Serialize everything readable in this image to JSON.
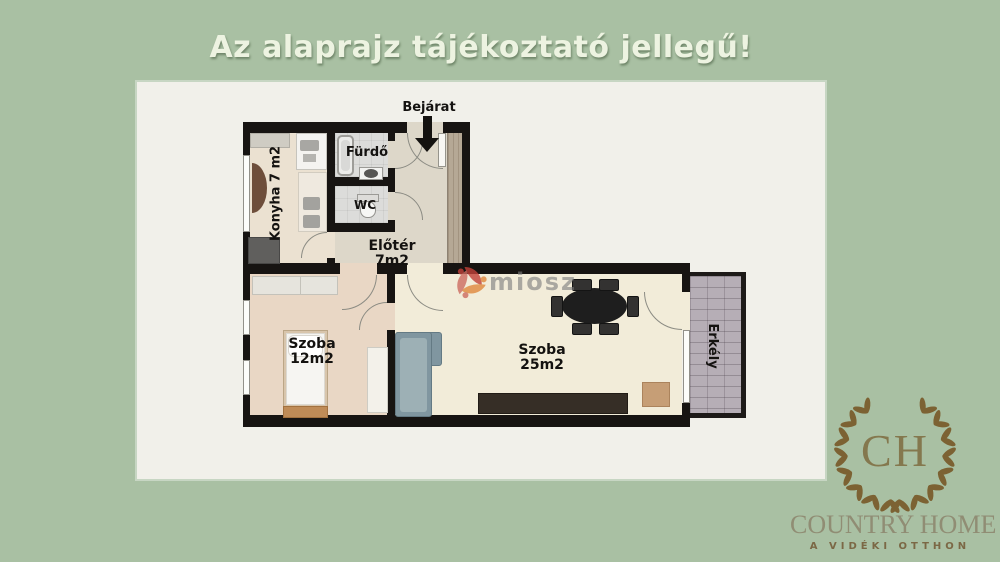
{
  "title": "Az alaprajz tájékoztató jellegű!",
  "floorplan": {
    "entrance_label": "Bejárat",
    "rooms": {
      "kitchen": "Konyha 7 m2",
      "bathroom": "Fürdő",
      "wc": "WC",
      "hall": "Előtér 7m2",
      "room_small": "Szoba 12m2",
      "room_large": "Szoba 25m2",
      "balcony": "Erkély"
    }
  },
  "watermark": {
    "text": "miosz"
  },
  "brand": {
    "monogram": "CH",
    "name": "COUNTRY HOME",
    "tagline": "A VIDÉKI OTTHON"
  },
  "colors": {
    "background": "#a9c0a3",
    "card": "#f1f0ea",
    "wall": "#171412",
    "title_text": "#edf3e1",
    "balcony_floor": "#b6aeb6",
    "wardrobe_wood": "#b5a895",
    "sofa": "#8096a0",
    "dining_set": "#1e1e1e",
    "logo_gold": "#7c6233",
    "watermark_red": "#c24139",
    "watermark_orange": "#e0883c"
  }
}
